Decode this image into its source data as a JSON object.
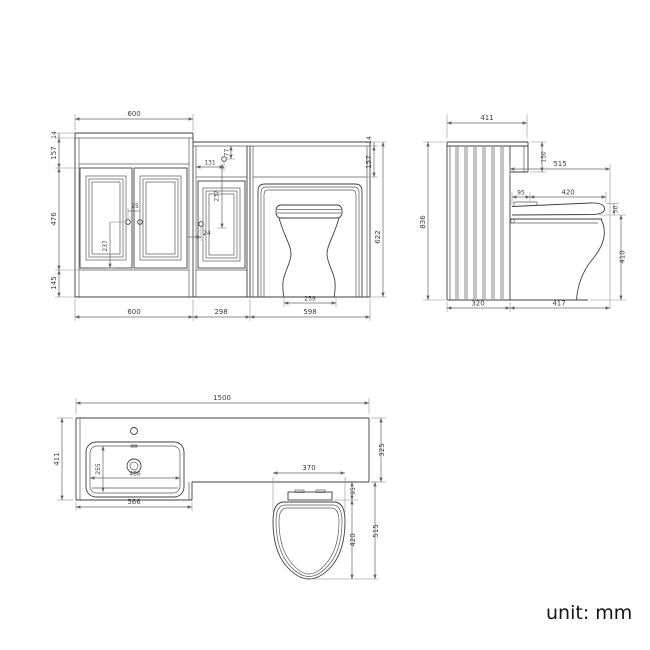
{
  "unit_note": "unit: mm",
  "colors": {
    "line": "#3f3f3f",
    "dimension": "#666666",
    "text": "#3d3d3d",
    "background": "#ffffff"
  },
  "front": {
    "top_width": "600",
    "worktop_thickness_left": "14",
    "frieze_left": "157",
    "door_height": "476",
    "plinth_height": "145",
    "worktop_thickness_right": "14",
    "frieze_right": "157",
    "total_height": "622",
    "vanity_width": "600",
    "mid_width": "298",
    "wc_width": "598",
    "toilet_base": "259",
    "mid_knob_offset_x": "131",
    "mid_knob_offset_y": "77",
    "mid_panel": "237",
    "mid_knob_edge": "24",
    "vanity_knob_gap": "25",
    "vanity_knob_drop": "237"
  },
  "side": {
    "worktop_depth": "411",
    "total_height": "836",
    "step_height": "150",
    "seat_total": "515",
    "seat_back": "95",
    "seat_length": "420",
    "seat_thickness": "50",
    "bowl_height": "410",
    "cabinet_depth": "320",
    "toilet_projection": "417"
  },
  "plan": {
    "total_width": "1500",
    "vanity_depth": "411",
    "counter_depth": "325",
    "basin_depth": "255",
    "basin_width": "486",
    "vanity_width": "566",
    "seat_width": "370",
    "seat_back": "95",
    "seat_length": "420",
    "seat_total": "515"
  }
}
